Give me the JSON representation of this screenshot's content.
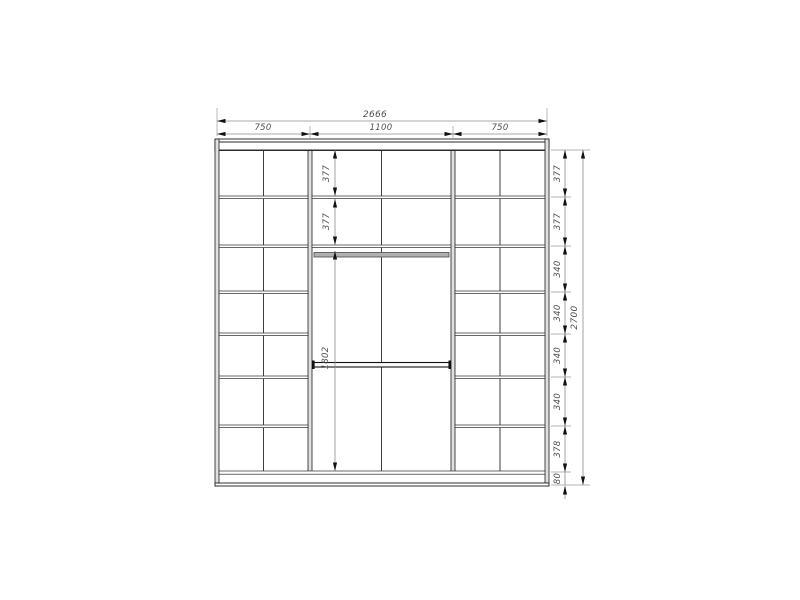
{
  "drawing": {
    "type": "wardrobe-elevation-technical-drawing",
    "dimensions": {
      "width": {
        "total": "2666",
        "sections": [
          "750",
          "1100",
          "750"
        ]
      },
      "height": {
        "total": "2700",
        "chain": [
          "377",
          "377",
          "340",
          "340",
          "340",
          "340",
          "378",
          "80"
        ]
      },
      "center": {
        "chain": [
          "377",
          "377",
          "1802"
        ]
      }
    },
    "colors": {
      "structure_line": "#1c1c1c",
      "panel_fill": "#e0e0e0",
      "dimension_line": "#8c8c8c",
      "dimension_text": "#4f4f4f",
      "rod_upper_fill": "#b0b0b0",
      "rod_lower_fill": "#fafafa",
      "background": "#ffffff"
    }
  }
}
